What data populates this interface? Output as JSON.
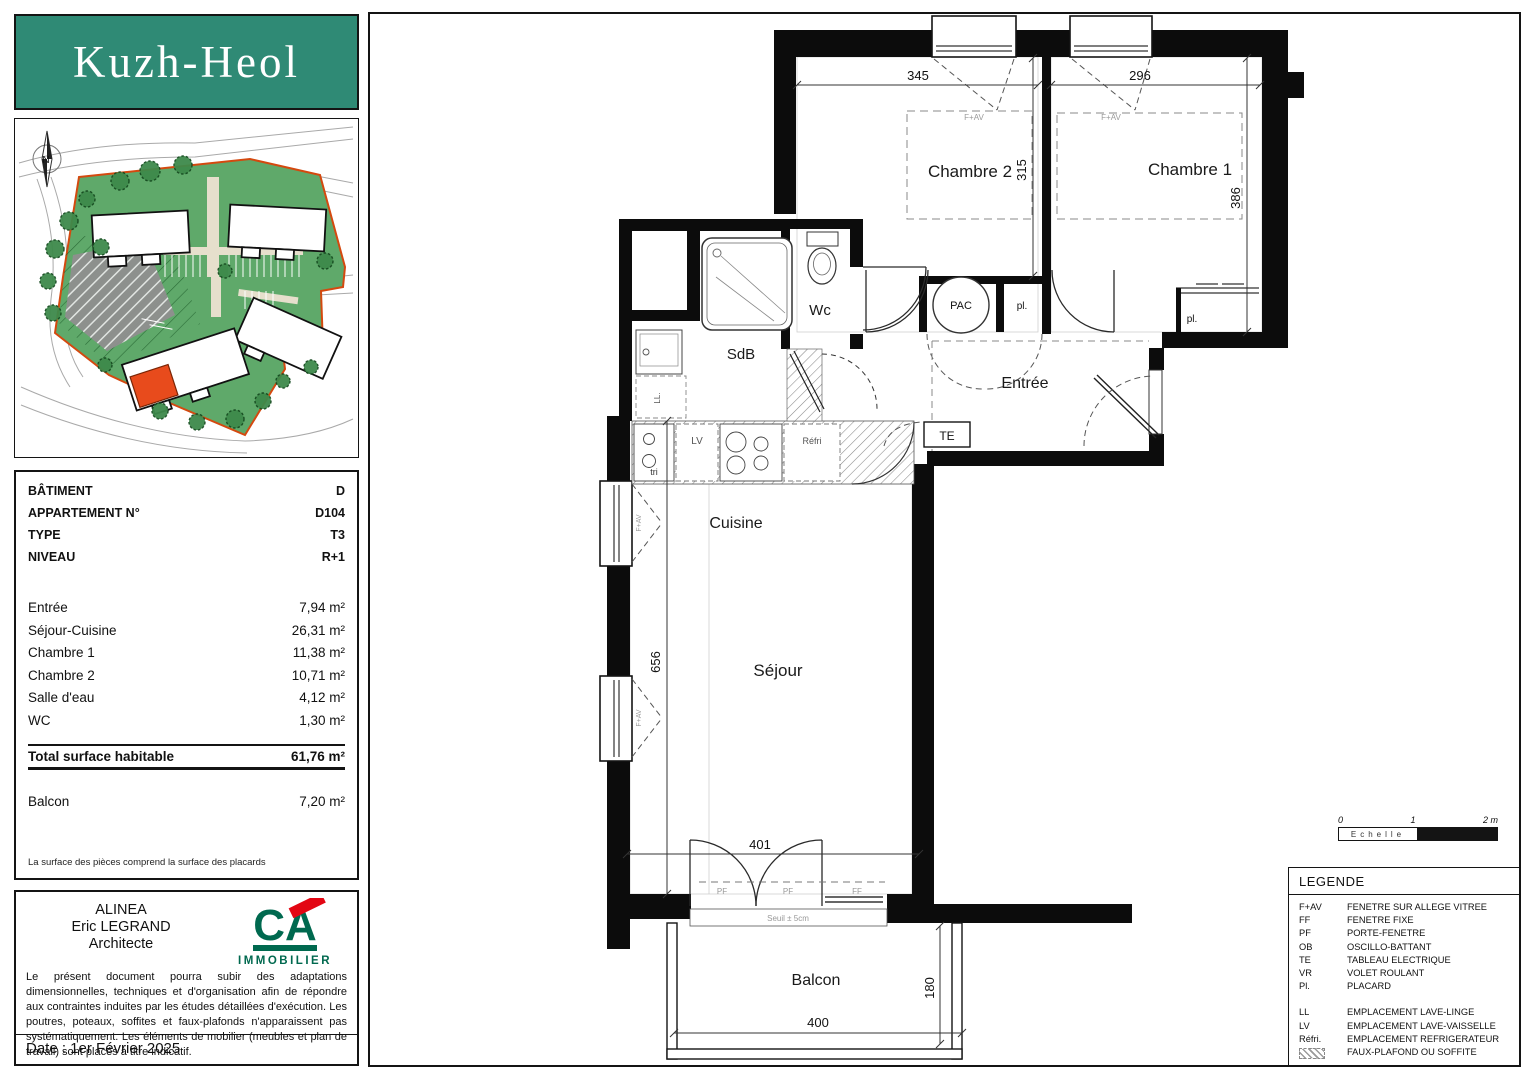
{
  "header": {
    "logo_text": "Kuzh-Heol"
  },
  "colors": {
    "accent_teal": "#2f8a75",
    "site_green": "#5fa96a",
    "boundary_orange": "#d4490f",
    "unit_red": "#e84b1c",
    "brand_green": "#00694f",
    "brand_red": "#e30613"
  },
  "site_plan": {
    "north_label": "N"
  },
  "info_panel": {
    "rows": [
      {
        "label": "BÂTIMENT",
        "value": "D"
      },
      {
        "label": "APPARTEMENT N°",
        "value": "D104"
      },
      {
        "label": "TYPE",
        "value": "T3"
      },
      {
        "label": "NIVEAU",
        "value": "R+1"
      }
    ],
    "areas": [
      {
        "label": "Entrée",
        "value": "7,94 m²"
      },
      {
        "label": "Séjour-Cuisine",
        "value": "26,31 m²"
      },
      {
        "label": "Chambre 1",
        "value": "11,38 m²"
      },
      {
        "label": "Chambre 2",
        "value": "10,71 m²"
      },
      {
        "label": "Salle d'eau",
        "value": "4,12 m²"
      },
      {
        "label": "WC",
        "value": "1,30 m²"
      }
    ],
    "total": {
      "label": "Total surface habitable",
      "value": "61,76 m²"
    },
    "balcony": {
      "label": "Balcon",
      "value": "7,20 m²"
    },
    "note": "La surface des pièces comprend la surface des placards"
  },
  "architect_panel": {
    "firm_lines": [
      "ALINEA",
      "Eric LEGRAND",
      "Architecte"
    ],
    "brand": "CA",
    "brand_sub": "IMMOBILIER",
    "disclaimer": "Le présent document pourra subir des adaptations dimensionnelles, techniques et d'organisation afin de répondre aux contraintes induites par les études détaillées d'exécution. Les poutres, poteaux, soffites et faux-plafonds n'apparaissent pas systématiquement. Les éléments de mobilier (meubles et plan de travail) sont placés à titre indicatif.",
    "date": "Date : 1er Février 2025"
  },
  "plan": {
    "rooms": {
      "chambre2": "Chambre 2",
      "chambre1": "Chambre 1",
      "wc": "Wc",
      "sdb": "SdB",
      "entree": "Entrée",
      "cuisine": "Cuisine",
      "sejour": "Séjour",
      "balcon": "Balcon"
    },
    "dims": {
      "chambre2_width": "345",
      "chambre1_width": "296",
      "chambre2_depth": "315",
      "chambre1_depth": "386",
      "sejour_height": "656",
      "bay_width": "401",
      "balcon_width": "400",
      "balcon_depth": "180"
    },
    "tags": {
      "pac": "PAC",
      "te": "TE",
      "pl": "pl.",
      "ll": "LL.",
      "lv": "LV",
      "refri": "Réfri",
      "tri": "tri",
      "pf": "PF",
      "ff": "FF",
      "fav": "F+AV",
      "seuil": "Seuil ± 5cm"
    }
  },
  "scale_bar": {
    "tick0": "0",
    "tick1": "1",
    "tick2": "2 m",
    "label": "Echelle"
  },
  "legend": {
    "title": "LEGENDE",
    "items": [
      {
        "abbr": "F+AV",
        "label": "FENETRE SUR ALLEGE VITREE"
      },
      {
        "abbr": "FF",
        "label": "FENETRE FIXE"
      },
      {
        "abbr": "PF",
        "label": "PORTE-FENETRE"
      },
      {
        "abbr": "OB",
        "label": "OSCILLO-BATTANT"
      },
      {
        "abbr": "TE",
        "label": "TABLEAU ELECTRIQUE"
      },
      {
        "abbr": "VR",
        "label": "VOLET ROULANT"
      },
      {
        "abbr": "Pl.",
        "label": "PLACARD"
      }
    ],
    "items2": [
      {
        "abbr": "LL",
        "label": "EMPLACEMENT LAVE-LINGE"
      },
      {
        "abbr": "LV",
        "label": "EMPLACEMENT LAVE-VAISSELLE"
      },
      {
        "abbr": "Réfri.",
        "label": "EMPLACEMENT REFRIGERATEUR"
      },
      {
        "abbr": "",
        "label": "FAUX-PLAFOND OU SOFFITE"
      }
    ]
  }
}
